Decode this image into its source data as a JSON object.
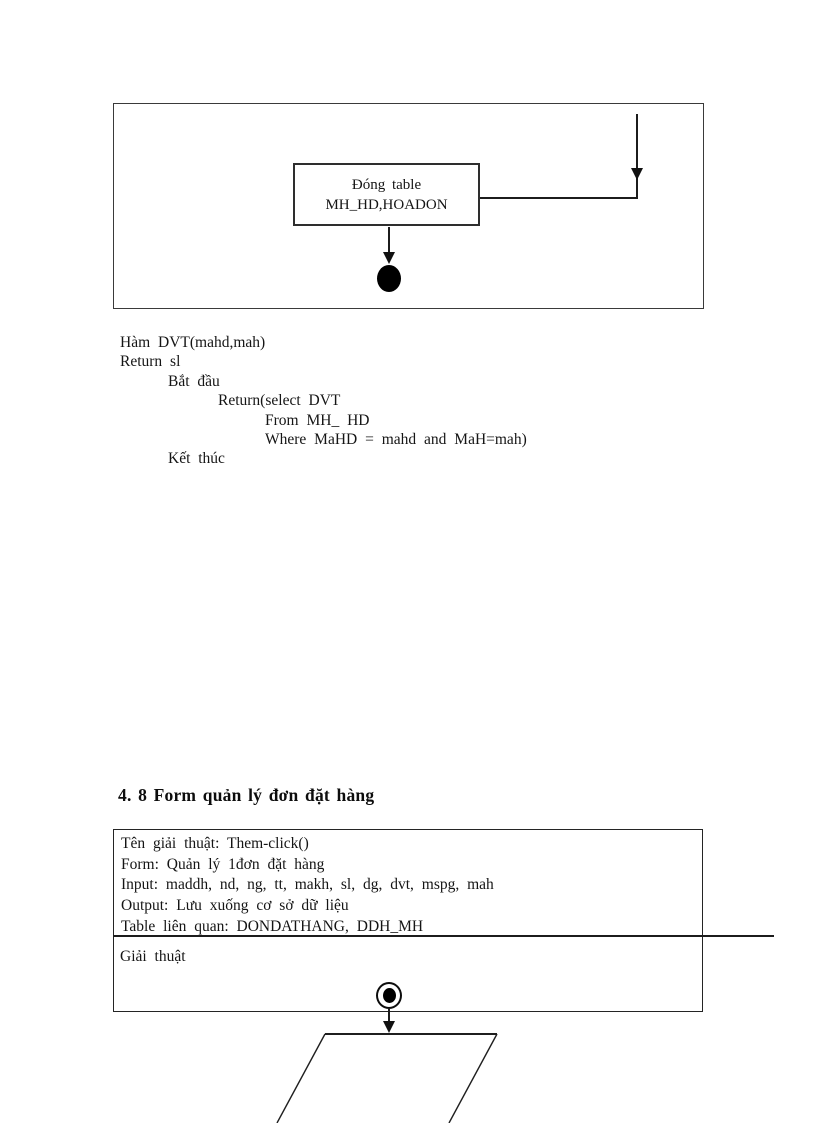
{
  "document": {
    "flowchart_top": {
      "process_box": {
        "line1": "Đóng table",
        "line2": "MH_HD,HOADON"
      }
    },
    "code_block": {
      "lines": [
        "Hàm DVT(mahd,mah)",
        "Return sl",
        "Bắt đầu",
        "Return(select DVT",
        "From MH_ HD",
        "Where MaHD = mahd and MaH=mah)",
        "Kết thúc"
      ]
    },
    "heading": "4. 8 Form quản lý đơn đặt hàng",
    "spec_table": {
      "info_rows": [
        "Tên giải thuật: Them-click()",
        "Form: Quản lý 1đơn đặt hàng",
        "Input: maddh, nd, ng, tt, makh, sl, dg, dvt, mspg, mah",
        "Output: Lưu xuống cơ sở dữ liệu",
        "Table liên quan: DONDATHANG, DDH_MH"
      ],
      "algorithm_label": "Giải thuật"
    },
    "colors": {
      "ink": "#151515",
      "line": "#1c1c1c",
      "background": "#ffffff"
    }
  }
}
